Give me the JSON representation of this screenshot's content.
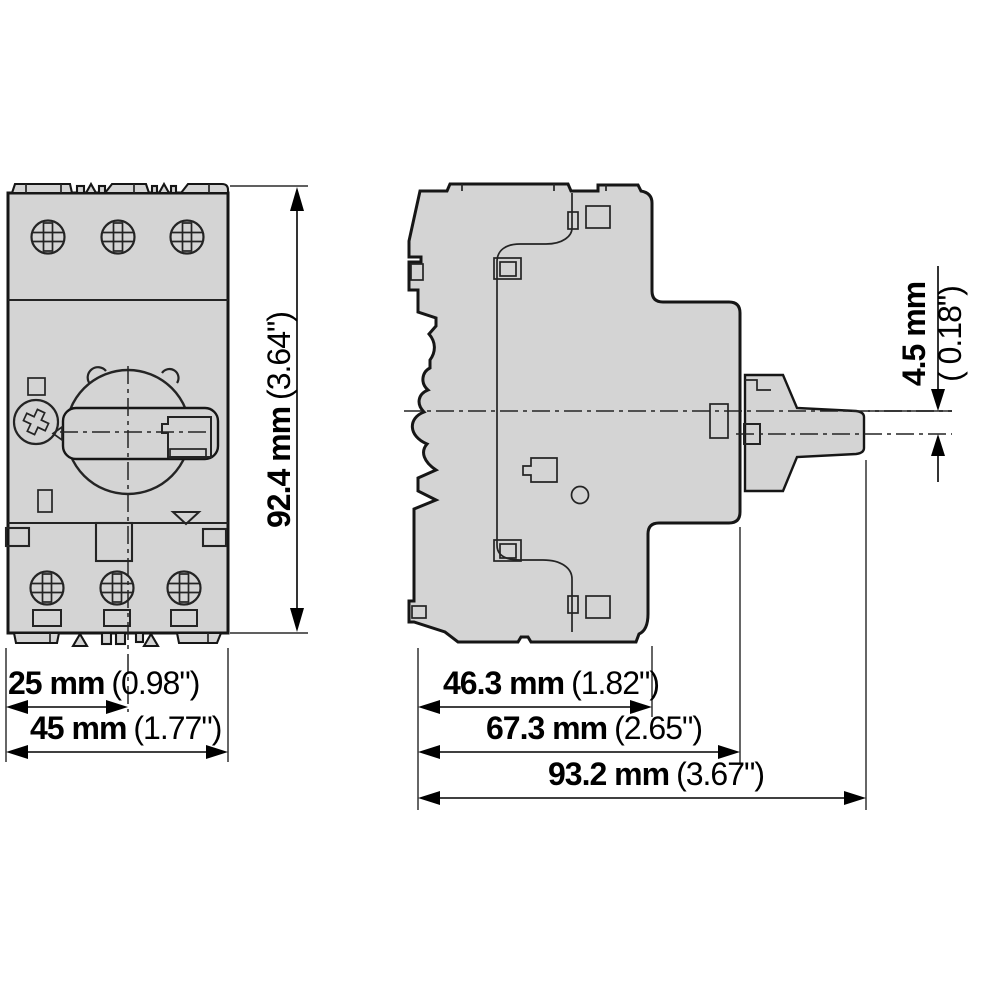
{
  "drawing": {
    "front_view": {
      "height": {
        "mm": "92.4 mm",
        "inch": "(3.64\")"
      },
      "mounting_width": {
        "mm": "25 mm",
        "inch": "(0.98\")"
      },
      "width": {
        "mm": "45 mm",
        "inch": "(1.77\")"
      }
    },
    "side_view": {
      "handle_offset": {
        "mm": "4.5 mm",
        "inch": "( 0.18\")"
      },
      "depth_body": {
        "mm": "46.3 mm",
        "inch": "(1.82\")"
      },
      "depth_mid": {
        "mm": "67.3 mm",
        "inch": "(2.65\")"
      },
      "depth_total": {
        "mm": "93.2 mm",
        "inch": "(3.67\")"
      }
    },
    "colors": {
      "body_fill": "#d4d4d4",
      "outline": "#161616",
      "detail_line": "#242424",
      "dimension": "#000000",
      "background": "#ffffff"
    }
  }
}
